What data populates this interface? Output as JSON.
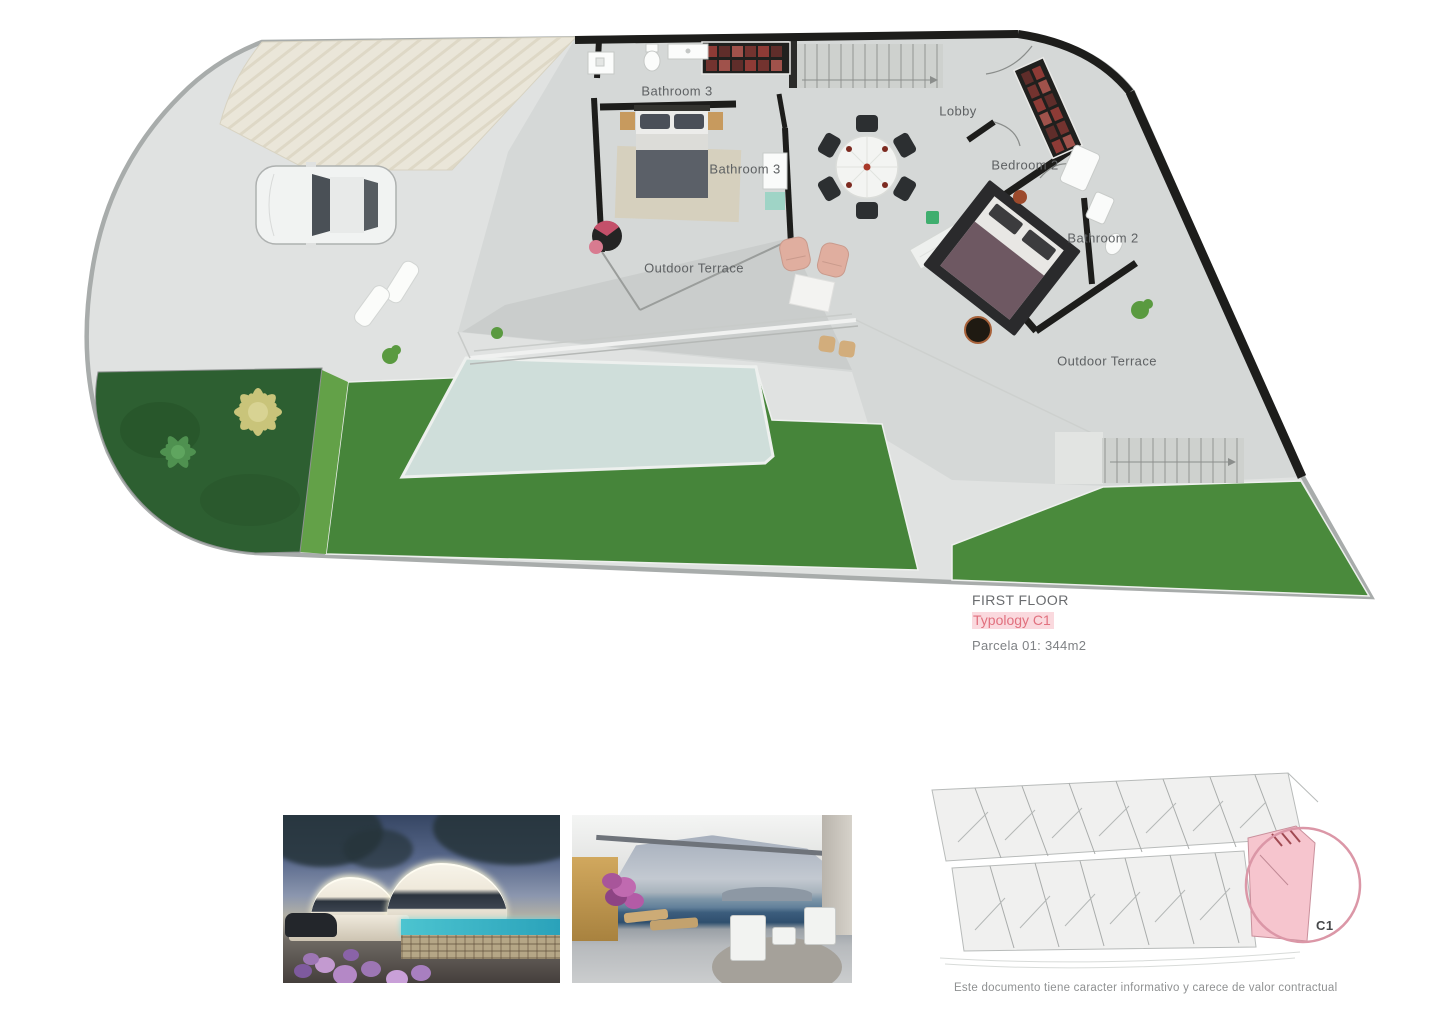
{
  "plan": {
    "labels": [
      {
        "text": "Bathroom 3"
      },
      {
        "text": "Lobby"
      },
      {
        "text": "Bathroom 3"
      },
      {
        "text": "Bedroom 2"
      },
      {
        "text": "Bathroom 2"
      },
      {
        "text": "Outdoor Terrace"
      },
      {
        "text": "Outdoor Terrace"
      }
    ]
  },
  "info": {
    "floor_title": "FIRST FLOOR",
    "typology": "Typology C1",
    "parcel": "Parcela 01: 344m2"
  },
  "site_plan": {
    "unit_label": "C1"
  },
  "footer": {
    "disclaimer": "Este documento tiene caracter informativo y carece de valor contractual"
  },
  "colors": {
    "typology_text": "#e1707e",
    "typology_highlight": "#fad9de",
    "lawn_green": "#46853a",
    "garden_dark_green": "#2d5f31",
    "pool_blue": "#cfdeda",
    "wall_black": "#1d1d1b",
    "site_highlight_pink": "#f6c5ce",
    "site_circle_pink": "#db97a7"
  }
}
